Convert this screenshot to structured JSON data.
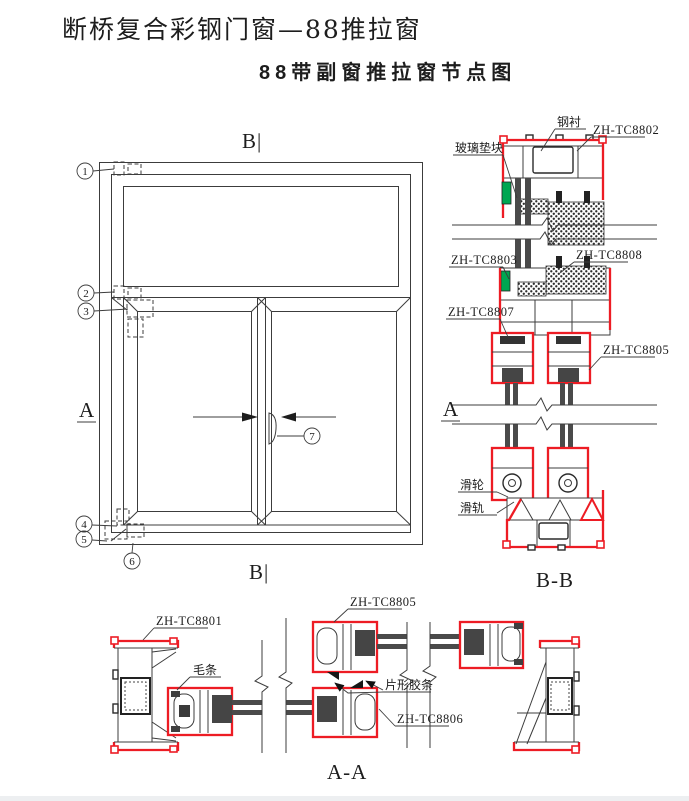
{
  "page": {
    "title": "断桥复合彩钢门窗—88推拉窗",
    "subtitle": "88带副窗推拉窗节点图"
  },
  "colors": {
    "profile_outline_red": "#ed1c24",
    "glazing_block_green": "#00a651",
    "line_dark": "#3c3c3c"
  },
  "elevation": {
    "section_label_top": "B|",
    "section_label_bottom": "B|",
    "section_label_left": "A",
    "callouts": [
      "1",
      "2",
      "3",
      "4",
      "5",
      "6",
      "7"
    ]
  },
  "section_bb": {
    "title": "B-B",
    "side_label": "A",
    "labels": {
      "steel_liner": "钢衬",
      "tc8802": "ZH-TC8802",
      "glazing_shim": "玻璃垫块",
      "tc8803": "ZH-TC8803",
      "tc8808": "ZH-TC8808",
      "tc8807": "ZH-TC8807",
      "tc8805": "ZH-TC8805",
      "roller": "滑轮",
      "rail": "滑轨"
    }
  },
  "section_aa": {
    "title": "A-A",
    "labels": {
      "tc8801": "ZH-TC8801",
      "brush_seal": "毛条",
      "tc8805": "ZH-TC8805",
      "sheet_gasket": "片形胶条",
      "tc8806": "ZH-TC8806"
    }
  }
}
